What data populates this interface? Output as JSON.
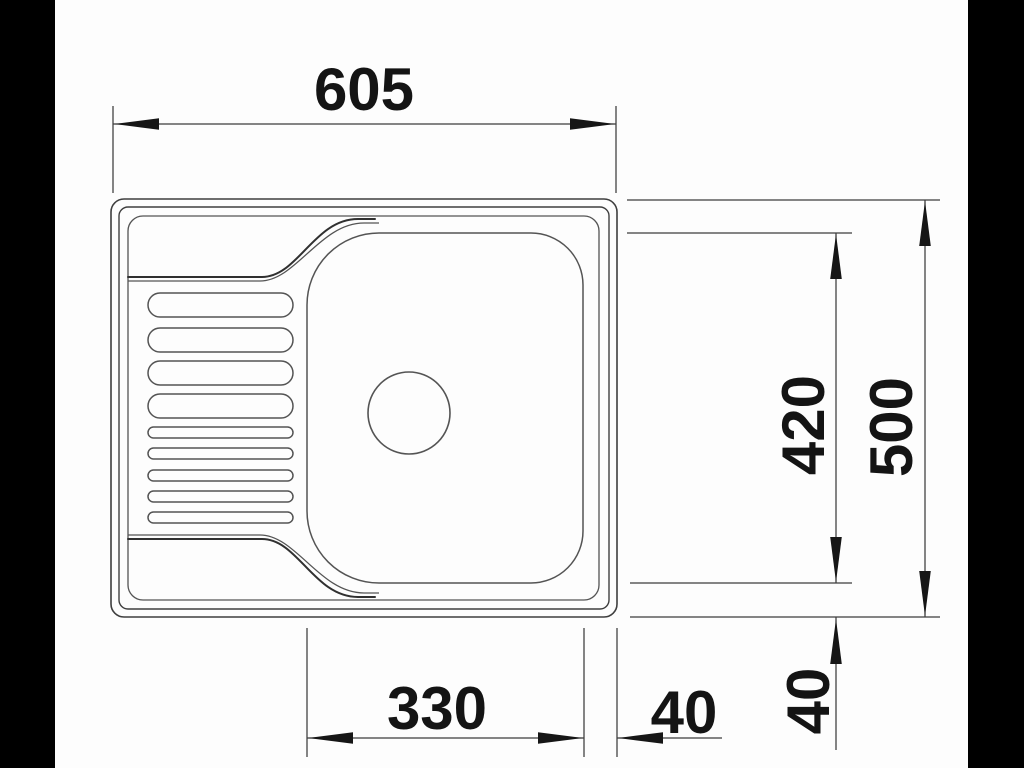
{
  "drawing": {
    "subject": "Kitchen sink with left drainboard and single bowl, top view dimensioned technical drawing",
    "units": "mm",
    "labels": {
      "overall_width": "605",
      "overall_depth": "500",
      "bowl_depth": "420",
      "bowl_width": "330",
      "bowl_right_offset": "40",
      "bowl_bottom_offset": "40"
    },
    "values": {
      "overall_width_mm": 605,
      "overall_depth_mm": 500,
      "bowl_depth_mm": 420,
      "bowl_width_mm": 330,
      "bowl_right_offset_mm": 40,
      "bowl_bottom_offset_mm": 40
    },
    "colors": {
      "letterbox": "#000000",
      "paper": "#fdfdfd",
      "outline": "#3f3f3f",
      "dimension_lines": "#3c3c3c",
      "arrowheads": "#161616",
      "text": "#141414"
    }
  }
}
